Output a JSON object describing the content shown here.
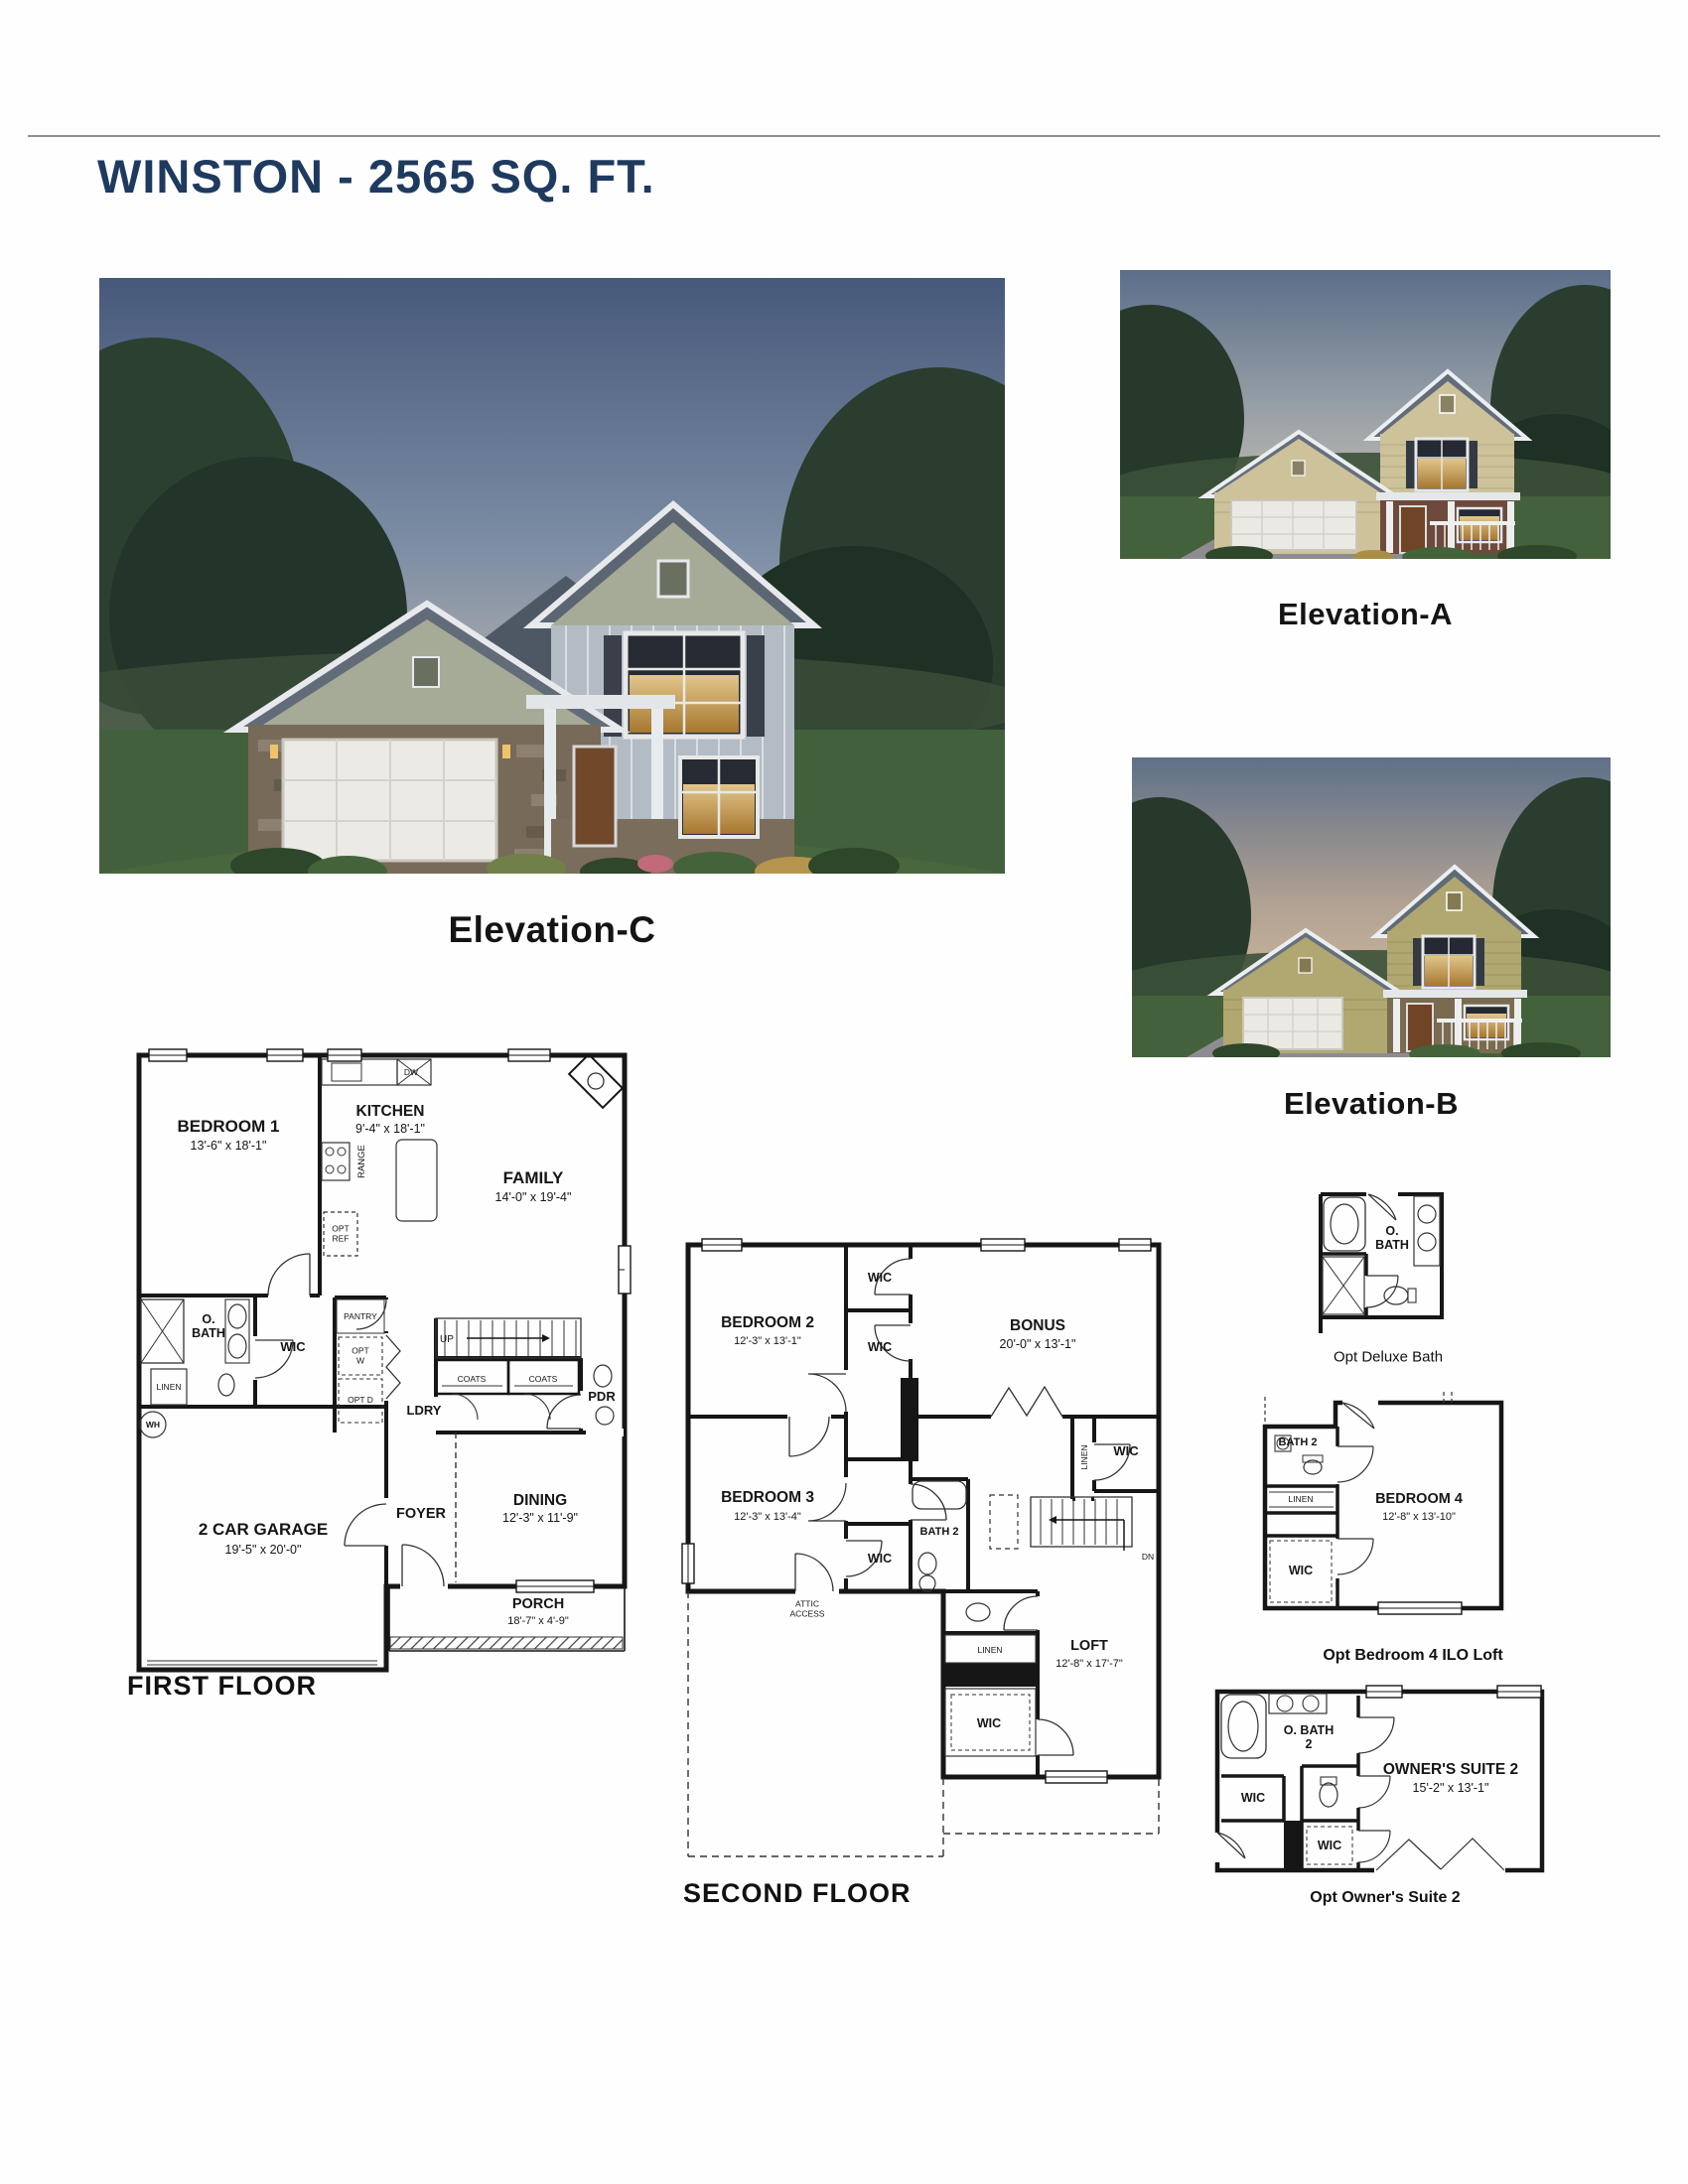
{
  "colors": {
    "title_navy": "#1f3a5f",
    "plan_ink": "#161616",
    "label_black": "#141414"
  },
  "page": {
    "title": "WINSTON - 2565 SQ. FT."
  },
  "elevations": {
    "c": {
      "label": "Elevation-C"
    },
    "a": {
      "label": "Elevation-A"
    },
    "b": {
      "label": "Elevation-B"
    }
  },
  "first_floor": {
    "title": "FIRST FLOOR",
    "rooms": {
      "bedroom1": {
        "name": "BEDROOM 1",
        "dims": "13'-6\" x 18'-1\""
      },
      "kitchen": {
        "name": "KITCHEN",
        "dims": "9'-4\" x 18'-1\""
      },
      "family": {
        "name": "FAMILY",
        "dims": "14'-0\" x 19'-4\""
      },
      "range": "RANGE",
      "opt_ref": "OPT REF",
      "dw": "DW",
      "owners_bath": "O. BATH",
      "wic": "WIC",
      "linen": "LINEN",
      "water_heater": "WH",
      "pantry": "PANTRY",
      "opt_washer": "OPT W",
      "opt_dryer": "OPT D",
      "laundry": "LDRY",
      "up": "UP",
      "coats_left": "COATS",
      "coats_right": "COATS",
      "powder": "PDR",
      "garage": {
        "name": "2 CAR GARAGE",
        "dims": "19'-5\" x 20'-0\""
      },
      "foyer": "FOYER",
      "dining": {
        "name": "DINING",
        "dims": "12'-3\" x 11'-9\""
      },
      "porch": {
        "name": "PORCH",
        "dims": "18'-7\" x 4'-9\""
      }
    }
  },
  "second_floor": {
    "title": "SECOND FLOOR",
    "rooms": {
      "bedroom2": {
        "name": "BEDROOM 2",
        "dims": "12'-3\" x 13'-1\""
      },
      "wic_top": "WIC",
      "wic_mid": "WIC",
      "bonus": {
        "name": "BONUS",
        "dims": "20'-0\" x 13'-1\""
      },
      "bedroom3": {
        "name": "BEDROOM 3",
        "dims": "12'-3\" x 13'-4\""
      },
      "wic_bedroom3": "WIC",
      "bath2": "BATH 2",
      "linen_hall": "LINEN",
      "wic_right": "WIC",
      "down": "DN",
      "attic_access": "ATTIC ACCESS",
      "loft": {
        "name": "LOFT",
        "dims": "12'-8\" x 17'-7\""
      },
      "linen_loft": "LINEN",
      "wic_loft": "WIC"
    }
  },
  "options": {
    "deluxe_bath": {
      "caption": "Opt Deluxe Bath",
      "rooms": {
        "owners_bath": "O. BATH"
      }
    },
    "bedroom4": {
      "caption": "Opt Bedroom 4 ILO Loft",
      "rooms": {
        "bath2": "BATH 2",
        "linen": "LINEN",
        "wic": "WIC",
        "bedroom4": {
          "name": "BEDROOM 4",
          "dims": "12'-8\" x 13'-10\""
        }
      }
    },
    "owners_suite2": {
      "caption": "Opt Owner's Suite 2",
      "rooms": {
        "owners_bath2": "O. BATH 2",
        "wic_a": "WIC",
        "wic_b": "WIC",
        "suite": {
          "name": "OWNER'S SUITE 2",
          "dims": "15'-2\" x 13'-1\""
        }
      }
    }
  }
}
